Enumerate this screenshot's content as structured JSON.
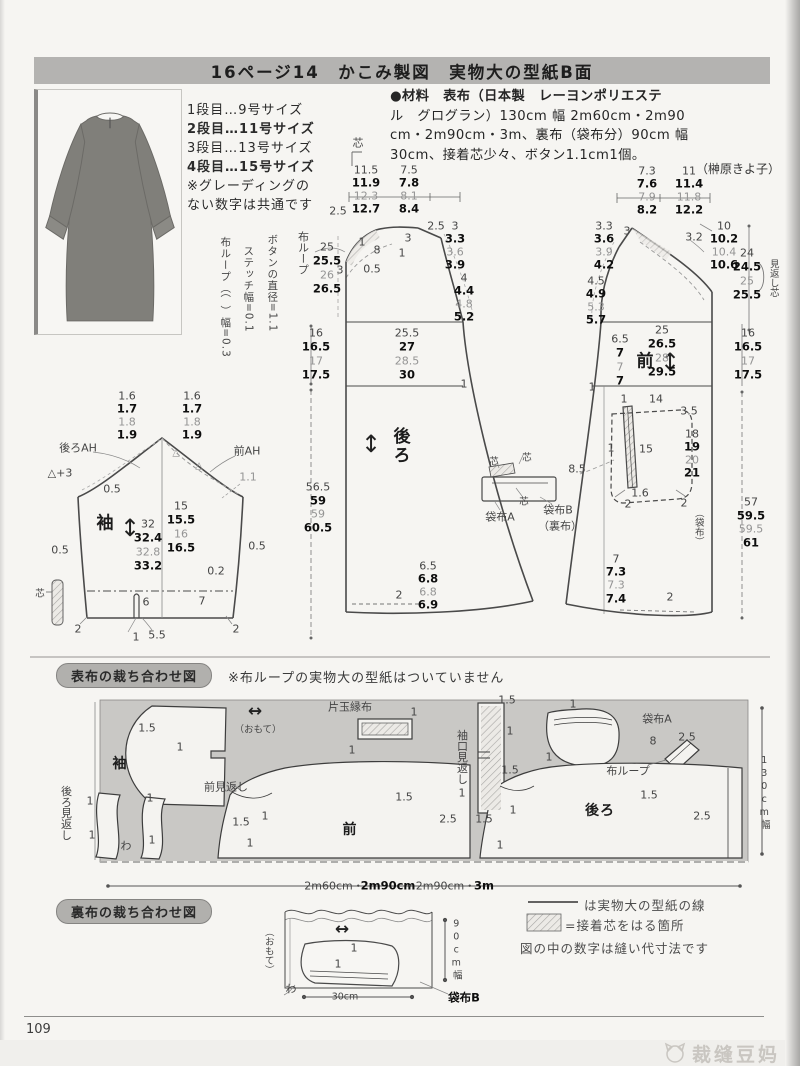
{
  "title": "16ページ14　かこみ製図　実物大の型紙B面",
  "sizes": {
    "lines": [
      "1段目…9号サイズ",
      "2段目…11号サイズ",
      "3段目…13号サイズ",
      "4段目…15号サイズ"
    ],
    "note1": "※グレーディングの",
    "note2": "ない数字は共通です"
  },
  "materials": {
    "lines": [
      "●材料　表布（日本製　レーヨンポリエステ",
      "ル　グログラン）130cm 幅 2m60cm・2m90",
      "cm・2m90cm・3m、裏布（袋布分）90cm 幅",
      "30cm、接着芯少々、ボタン1.1cm1個。"
    ],
    "credit": "（榊原きよ子）"
  },
  "draft": {
    "labels": [
      {
        "x": 358,
        "y": 143,
        "t": "芯",
        "c": "jp"
      },
      {
        "x": 366,
        "y": 170,
        "t": "11.5"
      },
      {
        "x": 366,
        "y": 183,
        "t": "11.9",
        "c": "b"
      },
      {
        "x": 366,
        "y": 196,
        "t": "12.3",
        "c": "g"
      },
      {
        "x": 366,
        "y": 209,
        "t": "12.7",
        "c": "b"
      },
      {
        "x": 409,
        "y": 170,
        "t": "7.5"
      },
      {
        "x": 409,
        "y": 183,
        "t": "7.8",
        "c": "b"
      },
      {
        "x": 409,
        "y": 196,
        "t": "8.1",
        "c": "g"
      },
      {
        "x": 409,
        "y": 209,
        "t": "8.4",
        "c": "b"
      },
      {
        "x": 303,
        "y": 253,
        "t": "布ループ",
        "c": "v",
        "n": "fabric-loop-label"
      },
      {
        "x": 338,
        "y": 211,
        "t": "2.5"
      },
      {
        "x": 327,
        "y": 247,
        "t": "25"
      },
      {
        "x": 327,
        "y": 261,
        "t": "25.5",
        "c": "b"
      },
      {
        "x": 327,
        "y": 275,
        "t": "26",
        "c": "g"
      },
      {
        "x": 327,
        "y": 289,
        "t": "26.5",
        "c": "b"
      },
      {
        "x": 377,
        "y": 250,
        "t": "8"
      },
      {
        "x": 340,
        "y": 270,
        "t": "3"
      },
      {
        "x": 362,
        "y": 242,
        "t": "1"
      },
      {
        "x": 408,
        "y": 238,
        "t": "3"
      },
      {
        "x": 402,
        "y": 253,
        "t": "1"
      },
      {
        "x": 372,
        "y": 269,
        "t": "0.5"
      },
      {
        "x": 436,
        "y": 226,
        "t": "2.5"
      },
      {
        "x": 455,
        "y": 226,
        "t": "3"
      },
      {
        "x": 455,
        "y": 239,
        "t": "3.3",
        "c": "b"
      },
      {
        "x": 455,
        "y": 252,
        "t": "3.6",
        "c": "g"
      },
      {
        "x": 455,
        "y": 265,
        "t": "3.9",
        "c": "b"
      },
      {
        "x": 464,
        "y": 278,
        "t": "4"
      },
      {
        "x": 464,
        "y": 291,
        "t": "4.4",
        "c": "b"
      },
      {
        "x": 464,
        "y": 304,
        "t": "4.8",
        "c": "g"
      },
      {
        "x": 464,
        "y": 317,
        "t": "5.2",
        "c": "b"
      },
      {
        "x": 407,
        "y": 333,
        "t": "25.5"
      },
      {
        "x": 407,
        "y": 347,
        "t": "27",
        "c": "b"
      },
      {
        "x": 407,
        "y": 361,
        "t": "28.5",
        "c": "g"
      },
      {
        "x": 407,
        "y": 375,
        "t": "30",
        "c": "b"
      },
      {
        "x": 316,
        "y": 333,
        "t": "16"
      },
      {
        "x": 316,
        "y": 347,
        "t": "16.5",
        "c": "b"
      },
      {
        "x": 316,
        "y": 361,
        "t": "17",
        "c": "g"
      },
      {
        "x": 316,
        "y": 375,
        "t": "17.5",
        "c": "b"
      },
      {
        "x": 464,
        "y": 384,
        "t": "1"
      },
      {
        "x": 399,
        "y": 446,
        "t": "後ろ",
        "c": "vu n",
        "n": "piece-name-back"
      },
      {
        "x": 371,
        "y": 444,
        "t": "↕",
        "c": "ar",
        "n": "grainline-arrow"
      },
      {
        "x": 318,
        "y": 487,
        "t": "56.5"
      },
      {
        "x": 318,
        "y": 501,
        "t": "59",
        "c": "b"
      },
      {
        "x": 318,
        "y": 514,
        "t": "59",
        "c": "g"
      },
      {
        "x": 318,
        "y": 528,
        "t": "60.5",
        "c": "b"
      },
      {
        "x": 428,
        "y": 566,
        "t": "6.5"
      },
      {
        "x": 428,
        "y": 579,
        "t": "6.8",
        "c": "b"
      },
      {
        "x": 428,
        "y": 592,
        "t": "6.8",
        "c": "g"
      },
      {
        "x": 428,
        "y": 605,
        "t": "6.9",
        "c": "b"
      },
      {
        "x": 399,
        "y": 595,
        "t": "2"
      },
      {
        "x": 272,
        "y": 283,
        "t": "ボタンの直径=1.1",
        "c": "v sm2",
        "n": "button-note"
      },
      {
        "x": 248,
        "y": 289,
        "t": "ステッチ幅=0.1",
        "c": "v sm2",
        "n": "stitch-note"
      },
      {
        "x": 225,
        "y": 297,
        "t": "布ループ（⌒）幅=0.3",
        "c": "v sm2",
        "n": "loop-note"
      },
      {
        "x": 494,
        "y": 462,
        "t": "芯",
        "c": "sm"
      },
      {
        "x": 527,
        "y": 458,
        "t": "芯",
        "c": "sm"
      },
      {
        "x": 524,
        "y": 502,
        "t": "芯",
        "c": "sm"
      },
      {
        "x": 500,
        "y": 517,
        "t": "袋布A",
        "n": "pocket-bag-a-label"
      },
      {
        "x": 558,
        "y": 510,
        "t": "袋布B",
        "n": "pocket-bag-b-label"
      },
      {
        "x": 560,
        "y": 526,
        "t": "（裏布）"
      },
      {
        "x": 577,
        "y": 469,
        "t": "8.5"
      },
      {
        "x": 647,
        "y": 171,
        "t": "7.3"
      },
      {
        "x": 647,
        "y": 184,
        "t": "7.6",
        "c": "b"
      },
      {
        "x": 647,
        "y": 197,
        "t": "7.9",
        "c": "g"
      },
      {
        "x": 647,
        "y": 210,
        "t": "8.2",
        "c": "b"
      },
      {
        "x": 689,
        "y": 171,
        "t": "11"
      },
      {
        "x": 689,
        "y": 184,
        "t": "11.4",
        "c": "b"
      },
      {
        "x": 689,
        "y": 197,
        "t": "11.8",
        "c": "g"
      },
      {
        "x": 689,
        "y": 210,
        "t": "12.2",
        "c": "b"
      },
      {
        "x": 604,
        "y": 226,
        "t": "3.3"
      },
      {
        "x": 604,
        "y": 239,
        "t": "3.6",
        "c": "b"
      },
      {
        "x": 604,
        "y": 252,
        "t": "3.9",
        "c": "g"
      },
      {
        "x": 604,
        "y": 265,
        "t": "4.2",
        "c": "b"
      },
      {
        "x": 627,
        "y": 231,
        "t": "3"
      },
      {
        "x": 694,
        "y": 237,
        "t": "3.2"
      },
      {
        "x": 724,
        "y": 226,
        "t": "10"
      },
      {
        "x": 724,
        "y": 239,
        "t": "10.2",
        "c": "b"
      },
      {
        "x": 724,
        "y": 252,
        "t": "10.4",
        "c": "g"
      },
      {
        "x": 724,
        "y": 265,
        "t": "10.6",
        "c": "b"
      },
      {
        "x": 747,
        "y": 253,
        "t": "24"
      },
      {
        "x": 747,
        "y": 267,
        "t": "24.5",
        "c": "b"
      },
      {
        "x": 747,
        "y": 281,
        "t": "25",
        "c": "g"
      },
      {
        "x": 747,
        "y": 295,
        "t": "25.5",
        "c": "b"
      },
      {
        "x": 773,
        "y": 278,
        "t": "見返し芯",
        "c": "v sm",
        "n": "facing-interfacing-label"
      },
      {
        "x": 596,
        "y": 281,
        "t": "4.5"
      },
      {
        "x": 596,
        "y": 294,
        "t": "4.9",
        "c": "b"
      },
      {
        "x": 596,
        "y": 307,
        "t": "5.3",
        "c": "g"
      },
      {
        "x": 596,
        "y": 320,
        "t": "5.7",
        "c": "b"
      },
      {
        "x": 646,
        "y": 362,
        "t": "前",
        "c": "n",
        "n": "piece-name-front"
      },
      {
        "x": 670,
        "y": 362,
        "t": "↕",
        "c": "ar",
        "n": "grainline-arrow"
      },
      {
        "x": 662,
        "y": 330,
        "t": "25"
      },
      {
        "x": 662,
        "y": 344,
        "t": "26.5",
        "c": "b"
      },
      {
        "x": 662,
        "y": 358,
        "t": "28",
        "c": "g"
      },
      {
        "x": 662,
        "y": 372,
        "t": "29.5",
        "c": "b"
      },
      {
        "x": 620,
        "y": 339,
        "t": "6.5"
      },
      {
        "x": 620,
        "y": 353,
        "t": "7",
        "c": "b"
      },
      {
        "x": 620,
        "y": 367,
        "t": "7",
        "c": "g"
      },
      {
        "x": 620,
        "y": 381,
        "t": "7",
        "c": "b"
      },
      {
        "x": 592,
        "y": 387,
        "t": "1"
      },
      {
        "x": 748,
        "y": 333,
        "t": "16"
      },
      {
        "x": 748,
        "y": 347,
        "t": "16.5",
        "c": "b"
      },
      {
        "x": 748,
        "y": 361,
        "t": "17",
        "c": "g"
      },
      {
        "x": 748,
        "y": 375,
        "t": "17.5",
        "c": "b"
      },
      {
        "x": 624,
        "y": 399,
        "t": "1"
      },
      {
        "x": 656,
        "y": 399,
        "t": "14"
      },
      {
        "x": 689,
        "y": 411,
        "t": "3.5"
      },
      {
        "x": 692,
        "y": 434,
        "t": "18"
      },
      {
        "x": 692,
        "y": 447,
        "t": "19",
        "c": "b"
      },
      {
        "x": 692,
        "y": 460,
        "t": "20",
        "c": "g"
      },
      {
        "x": 692,
        "y": 473,
        "t": "21",
        "c": "b"
      },
      {
        "x": 611,
        "y": 448,
        "t": "1"
      },
      {
        "x": 646,
        "y": 449,
        "t": "15"
      },
      {
        "x": 640,
        "y": 493,
        "t": "1.6"
      },
      {
        "x": 628,
        "y": 504,
        "t": "2"
      },
      {
        "x": 684,
        "y": 503,
        "t": "2"
      },
      {
        "x": 698,
        "y": 527,
        "t": "（袋布）",
        "c": "v sm"
      },
      {
        "x": 751,
        "y": 502,
        "t": "57"
      },
      {
        "x": 751,
        "y": 516,
        "t": "59.5",
        "c": "b"
      },
      {
        "x": 751,
        "y": 529,
        "t": "59.5",
        "c": "g"
      },
      {
        "x": 751,
        "y": 543,
        "t": "61",
        "c": "b"
      },
      {
        "x": 616,
        "y": 559,
        "t": "7"
      },
      {
        "x": 616,
        "y": 572,
        "t": "7.3",
        "c": "b"
      },
      {
        "x": 616,
        "y": 585,
        "t": "7.3",
        "c": "g"
      },
      {
        "x": 616,
        "y": 599,
        "t": "7.4",
        "c": "b"
      },
      {
        "x": 670,
        "y": 597,
        "t": "2"
      },
      {
        "x": 127,
        "y": 396,
        "t": "1.6"
      },
      {
        "x": 127,
        "y": 409,
        "t": "1.7",
        "c": "b"
      },
      {
        "x": 127,
        "y": 422,
        "t": "1.8",
        "c": "g"
      },
      {
        "x": 127,
        "y": 435,
        "t": "1.9",
        "c": "b"
      },
      {
        "x": 192,
        "y": 396,
        "t": "1.6"
      },
      {
        "x": 192,
        "y": 409,
        "t": "1.7",
        "c": "b"
      },
      {
        "x": 192,
        "y": 422,
        "t": "1.8",
        "c": "g"
      },
      {
        "x": 192,
        "y": 435,
        "t": "1.9",
        "c": "b"
      },
      {
        "x": 78,
        "y": 448,
        "t": "後ろAH",
        "n": "back-armhole-label"
      },
      {
        "x": 247,
        "y": 451,
        "t": "前AH",
        "n": "front-armhole-label"
      },
      {
        "x": 60,
        "y": 473,
        "t": "△+3"
      },
      {
        "x": 112,
        "y": 489,
        "t": "0.5"
      },
      {
        "x": 248,
        "y": 477,
        "t": "1.1",
        "c": "g"
      },
      {
        "x": 176,
        "y": 453,
        "t": "△",
        "c": "g sm"
      },
      {
        "x": 199,
        "y": 466,
        "t": "△",
        "c": "g sm"
      },
      {
        "x": 106,
        "y": 524,
        "t": "袖",
        "c": "n",
        "n": "piece-name-sleeve"
      },
      {
        "x": 130,
        "y": 528,
        "t": "↕",
        "c": "ar",
        "n": "grainline-arrow"
      },
      {
        "x": 148,
        "y": 524,
        "t": "32"
      },
      {
        "x": 148,
        "y": 538,
        "t": "32.4",
        "c": "b"
      },
      {
        "x": 148,
        "y": 552,
        "t": "32.8",
        "c": "g"
      },
      {
        "x": 148,
        "y": 566,
        "t": "33.2",
        "c": "b"
      },
      {
        "x": 181,
        "y": 506,
        "t": "15"
      },
      {
        "x": 181,
        "y": 520,
        "t": "15.5",
        "c": "b"
      },
      {
        "x": 181,
        "y": 534,
        "t": "16",
        "c": "g"
      },
      {
        "x": 181,
        "y": 548,
        "t": "16.5",
        "c": "b"
      },
      {
        "x": 60,
        "y": 550,
        "t": "0.5"
      },
      {
        "x": 257,
        "y": 546,
        "t": "0.5"
      },
      {
        "x": 216,
        "y": 571,
        "t": "0.2"
      },
      {
        "x": 146,
        "y": 602,
        "t": "6"
      },
      {
        "x": 202,
        "y": 601,
        "t": "7"
      },
      {
        "x": 78,
        "y": 629,
        "t": "2"
      },
      {
        "x": 136,
        "y": 637,
        "t": "1"
      },
      {
        "x": 157,
        "y": 635,
        "t": "5.5"
      },
      {
        "x": 236,
        "y": 629,
        "t": "2"
      },
      {
        "x": 40,
        "y": 594,
        "t": "芯",
        "c": "sm"
      }
    ]
  },
  "cutting_main": {
    "header": "表布の裁ち合わせ図",
    "note": "※布ループの実物大の型紙はついていません",
    "labels": [
      {
        "x": 120,
        "y": 764,
        "t": "袖",
        "c": "n2",
        "n": "layout-piece-sleeve"
      },
      {
        "x": 147,
        "y": 728,
        "t": "1.5"
      },
      {
        "x": 180,
        "y": 747,
        "t": "1"
      },
      {
        "x": 255,
        "y": 712,
        "t": "↔",
        "c": "ar2",
        "n": "grain-arrow"
      },
      {
        "x": 258,
        "y": 730,
        "t": "（おもて）",
        "c": "sm",
        "n": "right-side-label"
      },
      {
        "x": 350,
        "y": 707,
        "t": "片玉縁布",
        "n": "welt-strip-label"
      },
      {
        "x": 414,
        "y": 712,
        "t": "1"
      },
      {
        "x": 352,
        "y": 750,
        "t": "1"
      },
      {
        "x": 462,
        "y": 757,
        "t": "袖口見返し",
        "c": "v",
        "n": "cuff-facing-label"
      },
      {
        "x": 507,
        "y": 700,
        "t": "1.5"
      },
      {
        "x": 510,
        "y": 731,
        "t": "1"
      },
      {
        "x": 510,
        "y": 770,
        "t": "1.5"
      },
      {
        "x": 462,
        "y": 793,
        "t": "1"
      },
      {
        "x": 657,
        "y": 719,
        "t": "袋布A",
        "n": "pocket-bag-a-label"
      },
      {
        "x": 573,
        "y": 704,
        "t": "1"
      },
      {
        "x": 549,
        "y": 757,
        "t": "1"
      },
      {
        "x": 628,
        "y": 771,
        "t": "布ループ",
        "n": "fabric-loop-label"
      },
      {
        "x": 653,
        "y": 741,
        "t": "8"
      },
      {
        "x": 687,
        "y": 737,
        "t": "2.5"
      },
      {
        "x": 764,
        "y": 793,
        "t": "130cm幅",
        "c": "vu sm",
        "n": "fabric-width-label"
      },
      {
        "x": 66,
        "y": 813,
        "t": "後ろ見返し",
        "c": "v",
        "n": "back-facing-label"
      },
      {
        "x": 90,
        "y": 801,
        "t": "1"
      },
      {
        "x": 92,
        "y": 835,
        "t": "1"
      },
      {
        "x": 126,
        "y": 846,
        "t": "わ",
        "n": "fold-label"
      },
      {
        "x": 150,
        "y": 798,
        "t": "1"
      },
      {
        "x": 152,
        "y": 840,
        "t": "1"
      },
      {
        "x": 226,
        "y": 787,
        "t": "前見返し",
        "n": "front-facing-label"
      },
      {
        "x": 241,
        "y": 822,
        "t": "1.5"
      },
      {
        "x": 265,
        "y": 816,
        "t": "1"
      },
      {
        "x": 250,
        "y": 843,
        "t": "1"
      },
      {
        "x": 404,
        "y": 797,
        "t": "1.5"
      },
      {
        "x": 448,
        "y": 819,
        "t": "2.5"
      },
      {
        "x": 350,
        "y": 830,
        "t": "前",
        "c": "n2",
        "n": "layout-piece-front"
      },
      {
        "x": 484,
        "y": 819,
        "t": "1.5"
      },
      {
        "x": 513,
        "y": 810,
        "t": "1"
      },
      {
        "x": 600,
        "y": 811,
        "t": "後ろ",
        "c": "n2",
        "n": "layout-piece-back"
      },
      {
        "x": 649,
        "y": 795,
        "t": "1.5"
      },
      {
        "x": 702,
        "y": 816,
        "t": "2.5"
      },
      {
        "x": 500,
        "y": 845,
        "t": "1"
      },
      {
        "x": 334,
        "y": 886,
        "t": "2m60cm・",
        "n": "fabric-length"
      },
      {
        "x": 388,
        "y": 886,
        "t": "2m90cm",
        "c": "b",
        "n": "fabric-length"
      },
      {
        "x": 440,
        "y": 886,
        "t": "・2m90cm・",
        "n": "fabric-length"
      },
      {
        "x": 484,
        "y": 886,
        "t": "3m",
        "c": "b",
        "n": "fabric-length"
      }
    ]
  },
  "cutting_lining": {
    "header": "裏布の裁ち合わせ図",
    "labels": [
      {
        "x": 268,
        "y": 951,
        "t": "（おもて）",
        "c": "v sm",
        "n": "right-side-label"
      },
      {
        "x": 342,
        "y": 930,
        "t": "↔",
        "c": "ar2",
        "n": "grain-arrow"
      },
      {
        "x": 354,
        "y": 948,
        "t": "1"
      },
      {
        "x": 338,
        "y": 964,
        "t": "1"
      },
      {
        "x": 291,
        "y": 989,
        "t": "わ",
        "n": "fold-label"
      },
      {
        "x": 345,
        "y": 997,
        "t": "30cm",
        "c": "sm",
        "n": "lining-width"
      },
      {
        "x": 456,
        "y": 950,
        "t": "90cm幅",
        "c": "vu sm",
        "n": "lining-fabric-width"
      },
      {
        "x": 464,
        "y": 998,
        "t": "袋布B",
        "c": "b",
        "n": "pocket-bag-b-label"
      }
    ]
  },
  "legend": {
    "line_label": "は実物大の型紙の線",
    "fuse_label": "=接着芯をはる箇所",
    "note": "図の中の数字は縫い代寸法です"
  },
  "footer": {
    "page": "109",
    "watermark": "裁缝豆妈"
  }
}
